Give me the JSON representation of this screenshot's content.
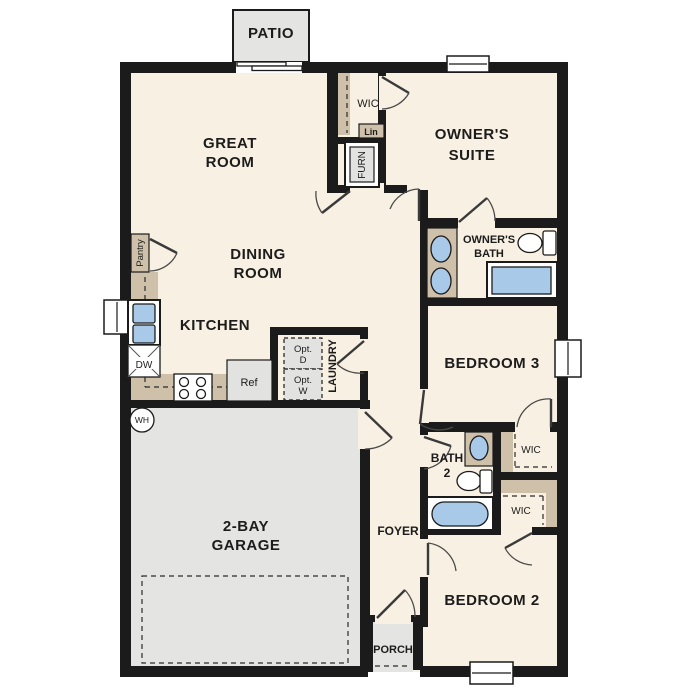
{
  "plan": {
    "type": "single-story floor plan",
    "colors": {
      "wall": "#1b1b1b",
      "floor": "#f8f0e2",
      "concrete_gray": "#e4e4e2",
      "counter_tan": "#cec0a9",
      "fixture_blue": "#a9c9e9",
      "appliance_gray": "#e2e2e0"
    },
    "labels": {
      "patio": "PATIO",
      "great_room_1": "GREAT",
      "great_room_2": "ROOM",
      "dining_1": "DINING",
      "dining_2": "ROOM",
      "kitchen": "KITCHEN",
      "owners_suite_1": "OWNER'S",
      "owners_suite_2": "SUITE",
      "owners_bath_1": "OWNER'S",
      "owners_bath_2": "BATH",
      "bedroom3": "BEDROOM 3",
      "bedroom2": "BEDROOM 2",
      "bath2_1": "BATH",
      "bath2_2": "2",
      "garage_1": "2-BAY",
      "garage_2": "GARAGE",
      "foyer": "FOYER",
      "porch": "PORCH",
      "laundry": "LAUNDRY",
      "wic_owner": "WIC",
      "wic_bed3": "WIC",
      "wic_bed2": "WIC",
      "lin": "Lin",
      "furn": "FURN",
      "pantry": "Pantry",
      "water_heater": "WH",
      "dishwasher": "DW",
      "refrigerator": "Ref",
      "opt_dryer_1": "Opt.",
      "opt_dryer_2": "D",
      "opt_washer_1": "Opt.",
      "opt_washer_2": "W"
    }
  }
}
